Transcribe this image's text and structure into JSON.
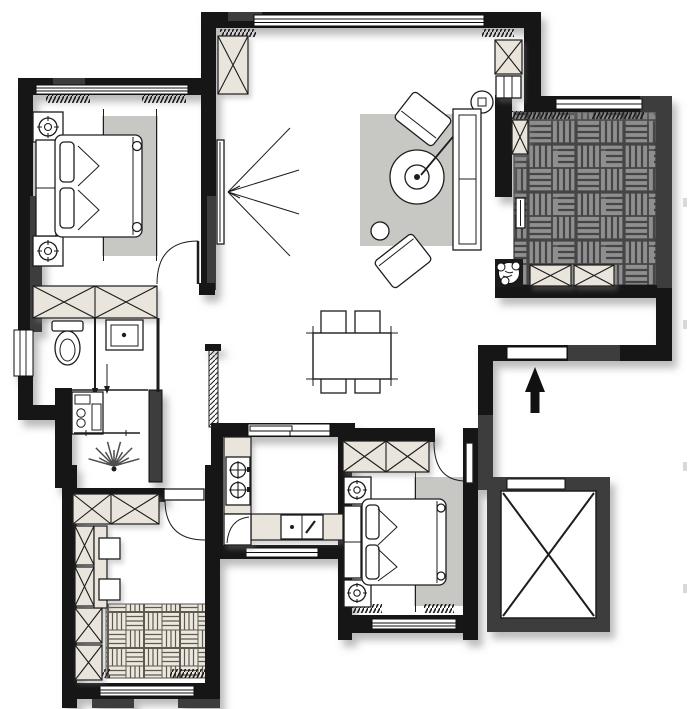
{
  "plan": {
    "type": "residential apartment floor plan",
    "view": "top-down 2D architectural drawing",
    "visible_text": [],
    "rooms": [
      {
        "id": "master-bedroom",
        "location": "top-left",
        "items": [
          "double-bed",
          "headboard",
          "nightstand-with-lamp",
          "nightstand-with-lamp",
          "area-rug",
          "built-in-wardrobe-2-sections",
          "hinged-door",
          "window-top",
          "window-left",
          "curtain-hatch"
        ]
      },
      {
        "id": "bathroom",
        "location": "left-middle",
        "items": [
          "toilet",
          "vanity-sink",
          "glass-partition",
          "washing-machine",
          "side-window"
        ]
      },
      {
        "id": "hallway",
        "location": "center-left",
        "items": [
          "sunburst-wall-light",
          "sliding-screen",
          "shelf",
          "pocket-wall"
        ]
      },
      {
        "id": "study",
        "location": "bottom-left",
        "items": [
          "built-in-wardrobe-2-sections",
          "wardrobe-column-4-cells",
          "desk",
          "desk-chair",
          "desk-chair",
          "parquet-platform",
          "hinged-door",
          "window-bottom",
          "curtain-hatch"
        ]
      },
      {
        "id": "kitchen",
        "location": "bottom-center",
        "items": [
          "l-shaped-counter",
          "two-burner-cooktop",
          "double-sink-with-faucet",
          "corner-cabinet",
          "sliding-door-top",
          "window-bottom"
        ]
      },
      {
        "id": "second-bedroom",
        "location": "bottom-center-right",
        "items": [
          "double-bed",
          "headboard",
          "nightstand-with-lamp",
          "nightstand-with-lamp",
          "area-rug",
          "built-in-wardrobe-2-sections",
          "hinged-door",
          "window-bottom",
          "curtain-hatch"
        ]
      },
      {
        "id": "living-room",
        "location": "top-center",
        "items": [
          "wall-mounted-tv",
          "tv-viewing-lines",
          "area-rug",
          "round-coffee-table",
          "arc-floor-lamp",
          "sofa",
          "accent-chair-rotated",
          "accent-chair-rotated",
          "round-side-table",
          "tall-storage-cabinet",
          "shoe-cabinet",
          "window-top"
        ]
      },
      {
        "id": "dining-area",
        "location": "center",
        "items": [
          "dining-table",
          "dining-chair",
          "dining-chair",
          "dining-chair",
          "dining-chair"
        ]
      },
      {
        "id": "balcony",
        "location": "top-right",
        "items": [
          "dark-parquet-decking",
          "storage-box",
          "storage-box",
          "small-cabinet",
          "potted-plant",
          "sliding-rail",
          "window-top",
          "curtain-hatch"
        ]
      },
      {
        "id": "entry-corridor",
        "location": "right-middle",
        "items": [
          "entrance-arrow",
          "entry-door-opening"
        ]
      },
      {
        "id": "elevator-shaft",
        "location": "bottom-right",
        "items": [
          "shaft-cross",
          "elevator-door-opening"
        ]
      }
    ],
    "symbols": {
      "wardrobe-storage": "rectangle with X cross",
      "window": "white band with parallel lines set in wall",
      "door": "leaf with quarter-circle swing arc",
      "entrance": "solid black arrow pointing up",
      "elevator": "square shaft with diagonal cross",
      "curtain": "dense hatched strip beside windows",
      "lamp": "circle with radial ticks",
      "cooktop-burner": "circle with cross"
    }
  },
  "colors": {
    "paper_white": "#ffffff",
    "wall_black": "#161616",
    "wall_dark": "#3e3e3e",
    "cabinet_fill": "#e9e5dc",
    "rug_gray": "#c7c7c4",
    "parquet_dark": "#8f8f8f",
    "parquet_dark_line": "#454545",
    "parquet_light": "#ece8df",
    "parquet_light_line": "#5e5a50",
    "line_dark": "#1d1d1d"
  }
}
